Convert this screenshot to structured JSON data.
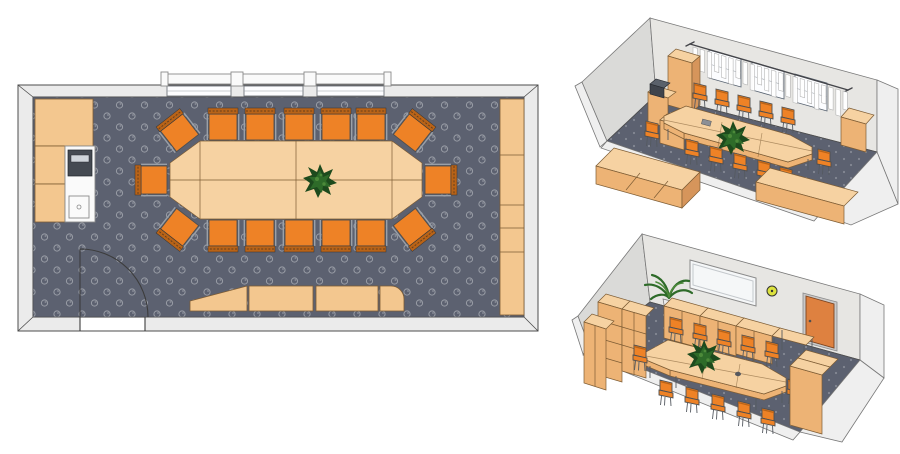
{
  "app": {
    "name": "room-planner-export",
    "description": "Conference room layout: one 2D floor plan and two 3D perspective views on white background",
    "views": [
      "floor-plan",
      "perspective-view-top",
      "perspective-view-bottom"
    ]
  },
  "colors": {
    "page_bg": "#ffffff",
    "wall_fill": "#ebebeb",
    "wall_face": "#e7e6e3",
    "wall_face_dark": "#dadad8",
    "wall_cut": "#efefef",
    "line": "#4c4c4c",
    "line2": "#787878",
    "carpet": "#5c6170",
    "carpet_motif": "#999da6",
    "carpet_dot": "#848893",
    "wood_top": "#f6d2a2",
    "wood_light": "#f3c78f",
    "wood_mid": "#edb375",
    "wood_dark": "#d6955b",
    "wood_stroke": "#7d5c34",
    "chair": "#ee8226",
    "chair_dark": "#b96317",
    "chair_frame": "#9aa0a8",
    "plant_dark": "#1d4a1d",
    "plant_mid": "#2e6b29",
    "plant_light": "#4c8a3a",
    "appliance": "#454a52",
    "white_obj": "#fafafa",
    "door": "#de8140",
    "clock": "#dce23e",
    "whiteboard": "#f5f7f8"
  },
  "floorplan": {
    "chair_count": 16,
    "chairs": [
      {
        "x": 223,
        "y": 126,
        "rot": 0
      },
      {
        "x": 260,
        "y": 126,
        "rot": 0
      },
      {
        "x": 299,
        "y": 126,
        "rot": 0
      },
      {
        "x": 336,
        "y": 126,
        "rot": 0
      },
      {
        "x": 371,
        "y": 126,
        "rot": 0
      },
      {
        "x": 223,
        "y": 234,
        "rot": 180
      },
      {
        "x": 260,
        "y": 234,
        "rot": 180
      },
      {
        "x": 299,
        "y": 234,
        "rot": 180
      },
      {
        "x": 336,
        "y": 234,
        "rot": 180
      },
      {
        "x": 371,
        "y": 234,
        "rot": 180
      },
      {
        "x": 153,
        "y": 180,
        "rot": -90
      },
      {
        "x": 439,
        "y": 180,
        "rot": 90
      },
      {
        "x": 179,
        "y": 132,
        "rot": -38
      },
      {
        "x": 413,
        "y": 132,
        "rot": 38
      },
      {
        "x": 179,
        "y": 228,
        "rot": -142
      },
      {
        "x": 413,
        "y": 228,
        "rot": 142
      }
    ],
    "windows": [
      {
        "x": 167,
        "w": 64
      },
      {
        "x": 244,
        "w": 59
      },
      {
        "x": 317,
        "w": 67
      }
    ],
    "window_posts": [
      {
        "x": 161,
        "w": 7
      },
      {
        "x": 231,
        "w": 12
      },
      {
        "x": 304,
        "w": 12
      },
      {
        "x": 384,
        "w": 7
      }
    ],
    "right_cabinet_dividers_y": [
      155,
      205,
      228,
      252
    ]
  },
  "view_top": {
    "chairs_back": [
      [
        700,
        95
      ],
      [
        722,
        101
      ],
      [
        744,
        107
      ],
      [
        766,
        113
      ],
      [
        788,
        119
      ]
    ],
    "chairs_front": [
      [
        692,
        151
      ],
      [
        716,
        158
      ],
      [
        740,
        165
      ],
      [
        764,
        172
      ],
      [
        786,
        179
      ]
    ],
    "chairs_end": [
      [
        652,
        133
      ],
      [
        824,
        161
      ]
    ],
    "curtain": {
      "count": 22,
      "len": 18
    }
  },
  "view_bottom": {
    "chairs_back": [
      [
        676,
        329
      ],
      [
        700,
        335
      ],
      [
        724,
        341
      ],
      [
        748,
        347
      ],
      [
        772,
        353
      ]
    ],
    "chairs_front": [
      [
        666,
        392
      ],
      [
        692,
        399
      ],
      [
        718,
        406
      ],
      [
        744,
        413
      ],
      [
        768,
        420
      ]
    ],
    "chairs_end": [
      [
        640,
        357
      ],
      [
        794,
        391
      ]
    ]
  }
}
